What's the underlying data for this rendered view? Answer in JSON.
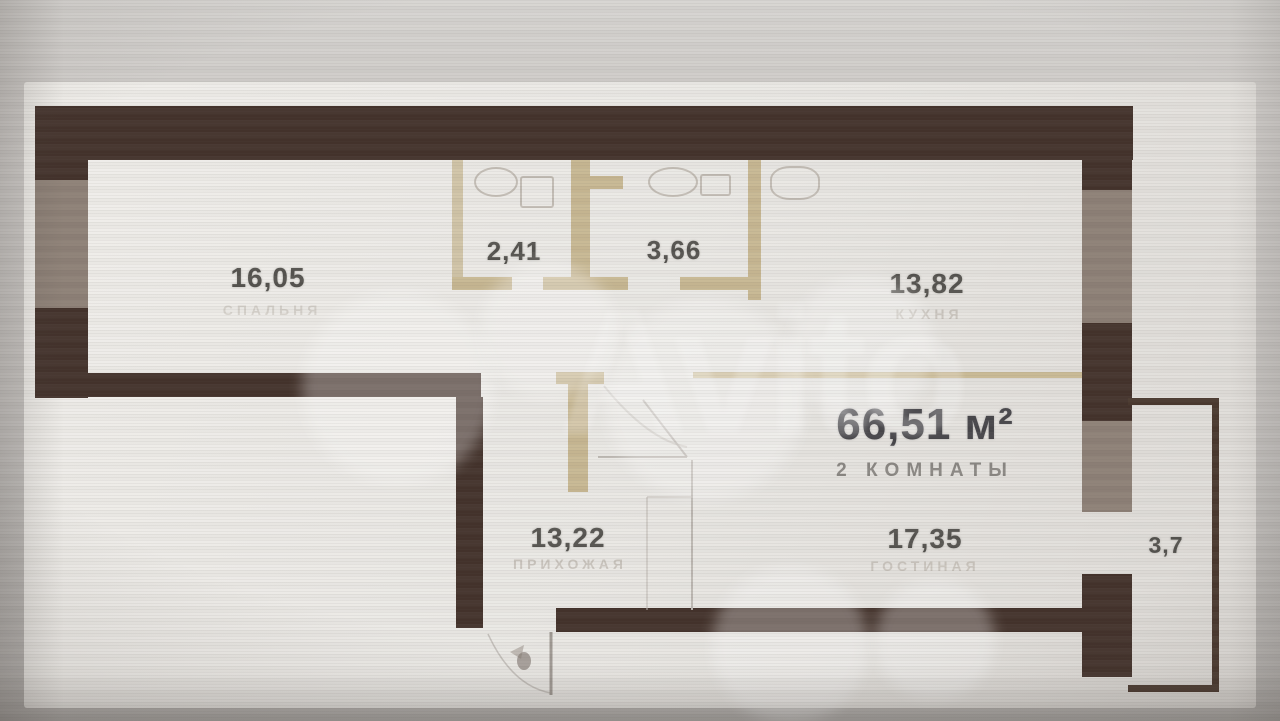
{
  "photo": {
    "watermark_text": "Avito"
  },
  "plan": {
    "total_area": "66,51 м²",
    "rooms_count_label": "2 КОМНАТЫ",
    "rooms": {
      "bedroom": {
        "area": "16,05",
        "label": "СПАЛЬНЯ"
      },
      "wc": {
        "area": "2,41"
      },
      "bathroom": {
        "area": "3,66"
      },
      "kitchen": {
        "area": "13,82",
        "label": "КУХНЯ"
      },
      "hallway": {
        "area": "13,22",
        "label": "ПРИХОЖАЯ"
      },
      "living": {
        "area": "17,35",
        "label": "ГОСТИНАЯ"
      },
      "balcony": {
        "area": "3,7"
      }
    },
    "colors": {
      "wall": "#44332c",
      "window_segment": "#8e8177",
      "partition": "#c8b893",
      "paper": "#eae8e4",
      "number_text": "#55534f",
      "title_text": "#47464a",
      "subtitle_text": "#8b8884",
      "ghost_label_text": "#c3bdb5"
    }
  }
}
